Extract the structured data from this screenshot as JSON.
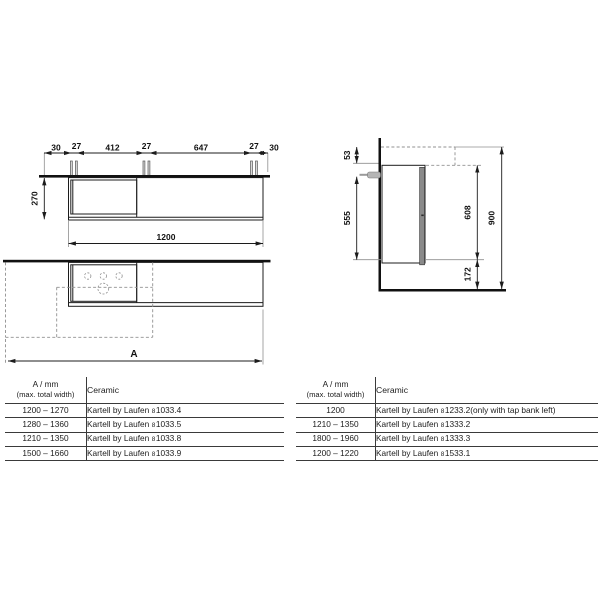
{
  "colors": {
    "line": "#1c1c1c",
    "dashed_line": "#909090",
    "tap_metal_gray": "#b5b5b5",
    "door_panel_gray": "#8a8a8a"
  },
  "front_view": {
    "top_dim_chain": [
      "30",
      "27",
      "412",
      "27",
      "647",
      "27",
      "30"
    ],
    "height_dim": "270",
    "cabinet_width_dim": "1200"
  },
  "plan_view": {
    "total_width_dim": "A"
  },
  "side_view": {
    "top_offset_dim": "53",
    "front_height_dim": "555",
    "underside_height_dim": "608",
    "total_height_dim": "900",
    "floor_clearance_dim": "172"
  },
  "tables": [
    {
      "header": {
        "col1_line1": "A / mm",
        "col1_line2": "(max. total width)",
        "col2": "Ceramic"
      },
      "rows": [
        {
          "width_range": "1200 – 1270",
          "brand": "Kartell by Laufen",
          "size_prefix": "8",
          "article_no": "1033.4",
          "note": ""
        },
        {
          "width_range": "1280 – 1360",
          "brand": "Kartell by Laufen",
          "size_prefix": "8",
          "article_no": "1033.5",
          "note": ""
        },
        {
          "width_range": "1210 – 1350",
          "brand": "Kartell by Laufen",
          "size_prefix": "8",
          "article_no": "1033.8",
          "note": ""
        },
        {
          "width_range": "1500 – 1660",
          "brand": "Kartell by Laufen",
          "size_prefix": "8",
          "article_no": "1033.9",
          "note": ""
        }
      ]
    },
    {
      "header": {
        "col1_line1": "A / mm",
        "col1_line2": "(max. total width)",
        "col2": "Ceramic"
      },
      "rows": [
        {
          "width_range": "1200",
          "brand": "Kartell by Laufen",
          "size_prefix": "8",
          "article_no": "1233.2",
          "note": "(only with tap bank left)"
        },
        {
          "width_range": "1210 – 1350",
          "brand": "Kartell by Laufen",
          "size_prefix": "8",
          "article_no": "1333.2",
          "note": ""
        },
        {
          "width_range": "1800 – 1960",
          "brand": "Kartell by Laufen",
          "size_prefix": "8",
          "article_no": "1333.3",
          "note": ""
        },
        {
          "width_range": "1200 – 1220",
          "brand": "Kartell by Laufen",
          "size_prefix": "8",
          "article_no": "1533.1",
          "note": ""
        }
      ]
    }
  ]
}
